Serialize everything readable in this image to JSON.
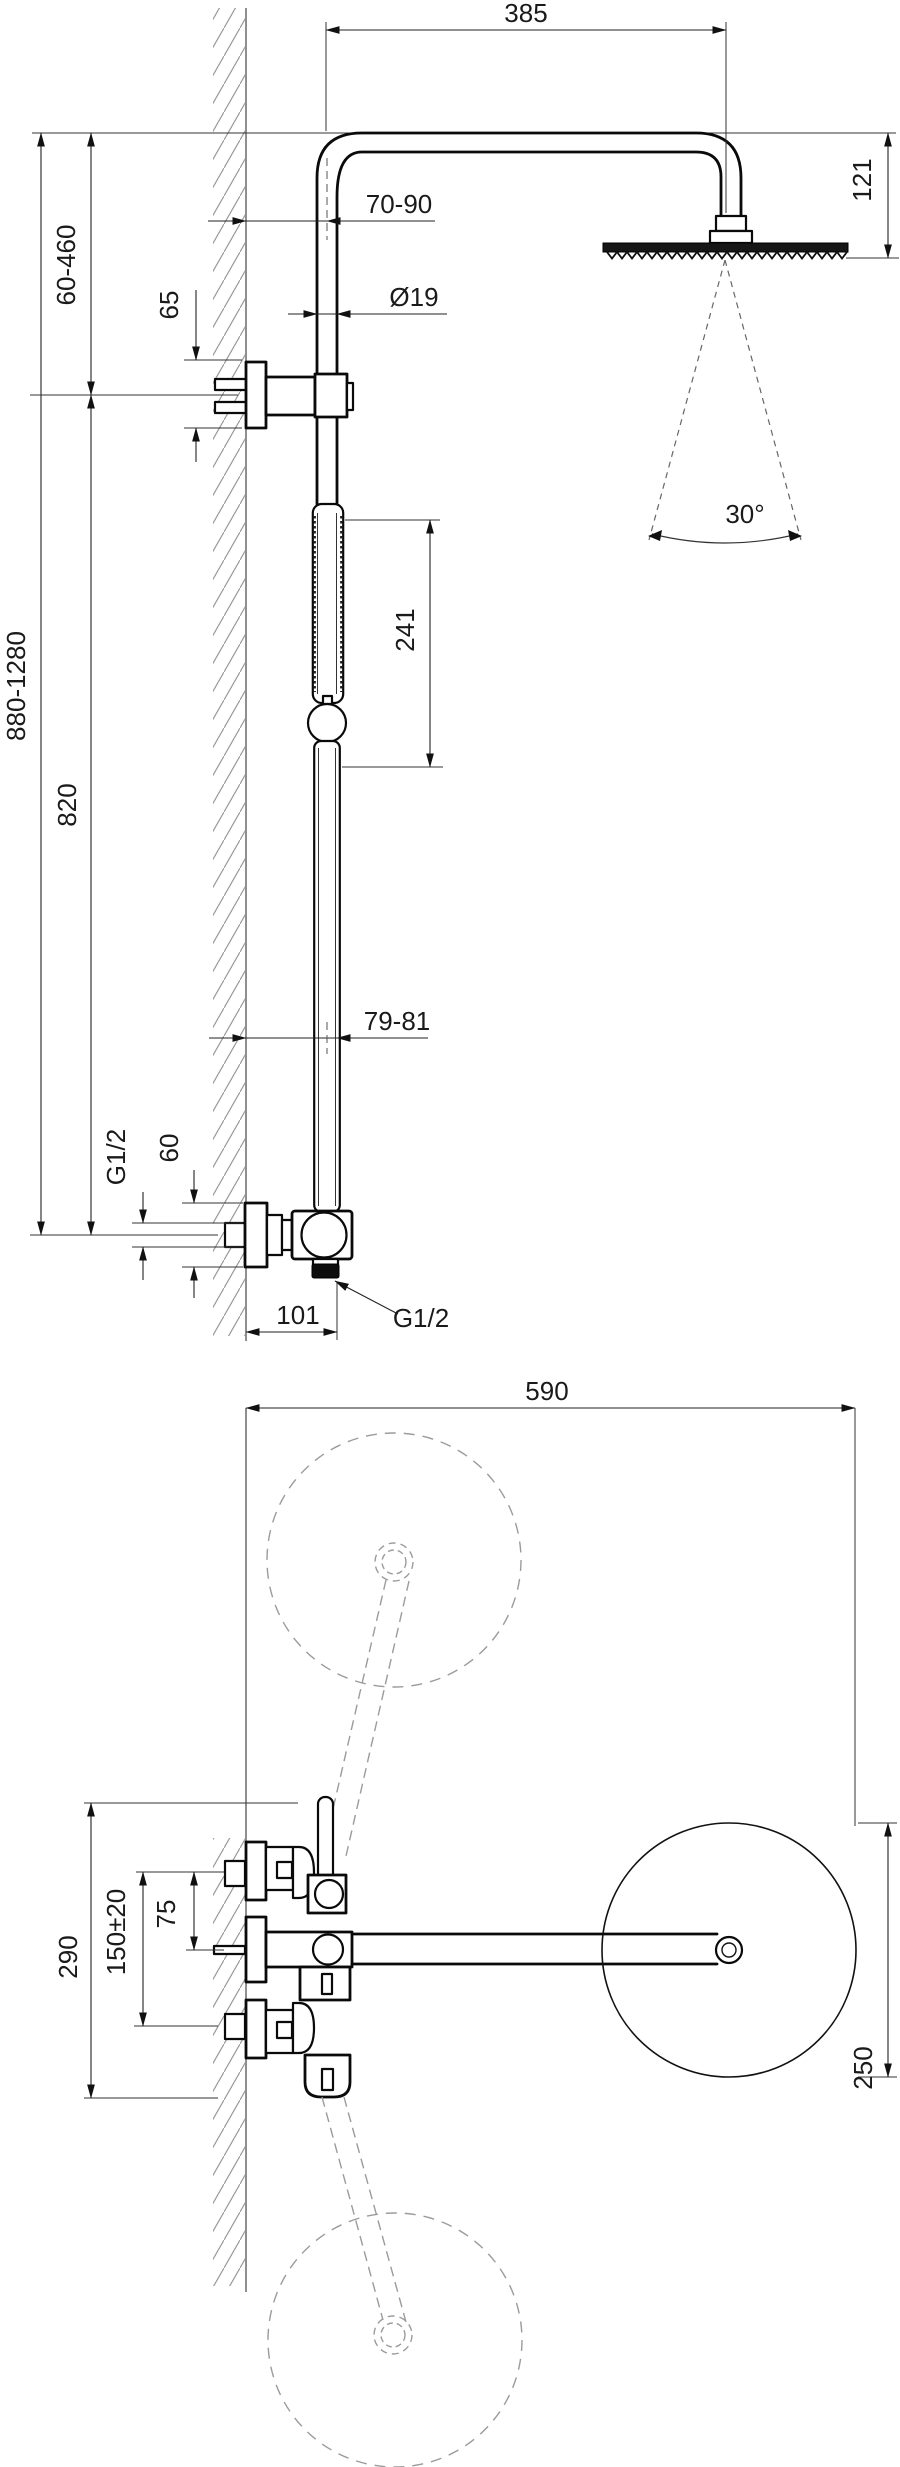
{
  "page": {
    "type": "technical-drawing",
    "subject": "wall-mounted shower column with overhead shower and thermostatic mixer, front elevation and plan view",
    "width_px": 900,
    "height_px": 2467,
    "background": "#ffffff",
    "object_line_color": "#0a0a0a",
    "dimension_line_color": "#222222",
    "phantom_line_color": "#9b9b9b",
    "units": "mm"
  },
  "front_view": {
    "labels": {
      "arm_reach": "385",
      "head_drop": "121",
      "wall_to_pipe": "70-90",
      "pipe_diameter": "Ø19",
      "bracket_escutcheon": "65",
      "upper_adjust_range": "60-460",
      "total_height_range": "880-1280",
      "slide_section": "241",
      "spray_angle": "30°",
      "fixed_pipe_length": "820",
      "wall_clearance": "79-81",
      "supply_thread": "G1/2",
      "mixer_escutcheon": "60",
      "outlet_offset": "101",
      "outlet_thread": "G1/2"
    }
  },
  "plan_view": {
    "labels": {
      "total_depth": "590",
      "valve_span": "290",
      "supply_distance": "150±20",
      "half_supply_distance": "75",
      "head_diameter": "250"
    }
  }
}
